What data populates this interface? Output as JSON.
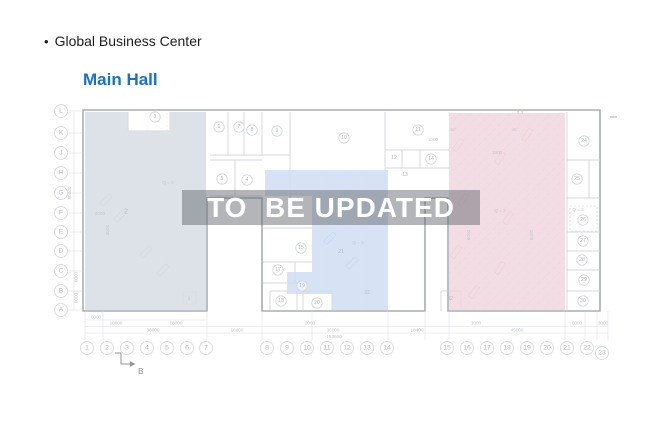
{
  "header": {
    "bullet": "•",
    "title": "Global Business Center",
    "subtitle": "Main Hall"
  },
  "watermark": {
    "text": "TO  BE UPDATED"
  },
  "colors": {
    "title": "#1d1d1f",
    "subtitle": "#1a70c7",
    "wall": "#a8adb5",
    "line": "#c6cad1",
    "faint": "#d8dbe0",
    "grid_dot": "#c0c5cc",
    "circle_stroke": "#d2d5da",
    "label": "#b4b8bf",
    "dim": "#c0c4cb",
    "anno": "#c3c7ce",
    "block_west": "#d6dde4",
    "block_center": "#cddcf2",
    "block_east": "#f0d5dd",
    "hatch": "#e2c3ce",
    "marker": "#8f949b",
    "watermark_band": "rgba(104,108,114,0.5)",
    "watermark_text": "#ffffff",
    "mark_west": "#b6c0cb",
    "mark_center": "#9fb7da",
    "mark_east": "#d4aaba"
  },
  "plan": {
    "row_labels": [
      {
        "t": "L",
        "y": 111
      },
      {
        "t": "K",
        "y": 133
      },
      {
        "t": "J",
        "y": 153
      },
      {
        "t": "H",
        "y": 173
      },
      {
        "t": "G",
        "y": 193
      },
      {
        "t": "F",
        "y": 213
      },
      {
        "t": "E",
        "y": 232
      },
      {
        "t": "D",
        "y": 251
      },
      {
        "t": "C",
        "y": 271
      },
      {
        "t": "B",
        "y": 291
      },
      {
        "t": "A",
        "y": 310
      }
    ],
    "col_labels": [
      {
        "t": "1",
        "x": 87
      },
      {
        "t": "2",
        "x": 107
      },
      {
        "t": "3",
        "x": 127
      },
      {
        "t": "4",
        "x": 147
      },
      {
        "t": "5",
        "x": 167
      },
      {
        "t": "6",
        "x": 187
      },
      {
        "t": "7",
        "x": 206
      },
      {
        "t": "8",
        "x": 267
      },
      {
        "t": "9",
        "x": 287
      },
      {
        "t": "10",
        "x": 307
      },
      {
        "t": "11",
        "x": 327
      },
      {
        "t": "12",
        "x": 347
      },
      {
        "t": "13",
        "x": 367
      },
      {
        "t": "14",
        "x": 387
      },
      {
        "t": "15",
        "x": 447
      },
      {
        "t": "16",
        "x": 467
      },
      {
        "t": "17",
        "x": 487
      },
      {
        "t": "18",
        "x": 507
      },
      {
        "t": "19",
        "x": 527
      },
      {
        "t": "20",
        "x": 547
      },
      {
        "t": "21",
        "x": 567
      },
      {
        "t": "22",
        "x": 587
      },
      {
        "t": "23",
        "x": 602,
        "y": 353
      }
    ],
    "rooms": [
      {
        "n": "3",
        "x": 155,
        "y": 117,
        "c": 1
      },
      {
        "n": "6",
        "x": 219,
        "y": 127,
        "c": 1
      },
      {
        "n": "7",
        "x": 239,
        "y": 127,
        "c": 1
      },
      {
        "n": "8",
        "x": 252,
        "y": 130,
        "c": 1
      },
      {
        "n": "9",
        "x": 277,
        "y": 131,
        "c": 1
      },
      {
        "n": "10",
        "x": 344,
        "y": 138,
        "c": 1
      },
      {
        "n": "11",
        "x": 418,
        "y": 130,
        "c": 1
      },
      {
        "n": "12",
        "x": 394,
        "y": 158,
        "c": 0
      },
      {
        "n": "13",
        "x": 405,
        "y": 175,
        "c": 0
      },
      {
        "n": "14",
        "x": 431,
        "y": 159,
        "c": 1
      },
      {
        "n": "5",
        "x": 222,
        "y": 179,
        "c": 1
      },
      {
        "n": "4",
        "x": 247,
        "y": 180,
        "c": 1
      },
      {
        "n": "2",
        "x": 126,
        "y": 212,
        "c": 0,
        "f": 7
      },
      {
        "n": "1",
        "x": 189,
        "y": 298,
        "c": 0,
        "f": 4.5
      },
      {
        "n": "15",
        "x": 301,
        "y": 248,
        "c": 1
      },
      {
        "n": "17",
        "x": 278,
        "y": 270,
        "c": 1
      },
      {
        "n": "19",
        "x": 302,
        "y": 286,
        "c": 1
      },
      {
        "n": "18",
        "x": 281,
        "y": 301,
        "c": 1
      },
      {
        "n": "20",
        "x": 317,
        "y": 303,
        "c": 1
      },
      {
        "n": "21",
        "x": 341,
        "y": 252,
        "c": 0
      },
      {
        "n": "22",
        "x": 367,
        "y": 293,
        "c": 0
      },
      {
        "n": "32",
        "x": 450,
        "y": 299,
        "c": 0
      },
      {
        "n": "24",
        "x": 584,
        "y": 141,
        "c": 1
      },
      {
        "n": "25",
        "x": 577,
        "y": 179,
        "c": 1
      },
      {
        "n": "26",
        "x": 583,
        "y": 220,
        "c": 1
      },
      {
        "n": "27",
        "x": 583,
        "y": 241,
        "c": 1
      },
      {
        "n": "28",
        "x": 582,
        "y": 260,
        "c": 1
      },
      {
        "n": "29",
        "x": 584,
        "y": 280,
        "c": 1
      },
      {
        "n": "30",
        "x": 583,
        "y": 301,
        "c": 1
      }
    ],
    "annotations": [
      {
        "t": "Q = 3",
        "x": 168,
        "y": 184
      },
      {
        "t": "Q = 3",
        "x": 358,
        "y": 244
      },
      {
        "t": "Q = 3",
        "x": 578,
        "y": 211
      },
      {
        "t": "Q = 3",
        "x": 500,
        "y": 212
      },
      {
        "t": "2000",
        "x": 100,
        "y": 215
      },
      {
        "t": "3000",
        "x": 109,
        "y": 230,
        "rot": -90
      },
      {
        "t": "2.3",
        "x": 520,
        "y": 114
      },
      {
        "t": "45°",
        "x": 453,
        "y": 131
      },
      {
        "t": "45°",
        "x": 515,
        "y": 131
      },
      {
        "t": "1000",
        "x": 433,
        "y": 141
      },
      {
        "t": "1900",
        "x": 497,
        "y": 154
      },
      {
        "t": "6000",
        "x": 470,
        "y": 235,
        "rot": -90
      },
      {
        "t": "6000",
        "x": 533,
        "y": 235,
        "rot": -90
      }
    ],
    "dims_bottom": [
      {
        "t": "6000",
        "x": 96,
        "y": 318.5
      },
      {
        "t": "18000",
        "x": 116,
        "y": 324.5
      },
      {
        "t": "18000",
        "x": 176,
        "y": 324.5
      },
      {
        "t": "2000",
        "x": 310,
        "y": 324.5
      },
      {
        "t": "1000",
        "x": 476,
        "y": 324.5
      },
      {
        "t": "6000",
        "x": 577,
        "y": 324.5
      },
      {
        "t": "3000",
        "x": 603,
        "y": 324.5
      },
      {
        "t": "36000",
        "x": 153,
        "y": 331.3
      },
      {
        "t": "18000",
        "x": 237,
        "y": 331.3
      },
      {
        "t": "36000",
        "x": 333,
        "y": 331.3
      },
      {
        "t": "18400",
        "x": 417,
        "y": 331.3
      },
      {
        "t": "45000",
        "x": 517,
        "y": 331.3
      },
      {
        "t": "153660",
        "x": 334,
        "y": 338
      }
    ],
    "dims_left": [
      {
        "t": "60000",
        "x": 71,
        "y": 193
      },
      {
        "t": "6000",
        "x": 77.5,
        "y": 277
      },
      {
        "t": "6000",
        "x": 77.5,
        "y": 298
      }
    ],
    "outline": "M83,110 H600 V311 H448 V198 H425 V311 H262 V198 H207 V311 H83 Z",
    "interior": [
      [
        210,
        155,
        290,
        155
      ],
      [
        228,
        112,
        228,
        155
      ],
      [
        244,
        112,
        244,
        155
      ],
      [
        262,
        112,
        262,
        155
      ],
      [
        290,
        112,
        290,
        198
      ],
      [
        385,
        112,
        385,
        198
      ],
      [
        385,
        150,
        449,
        150
      ],
      [
        402,
        150,
        402,
        168
      ],
      [
        420,
        150,
        420,
        168
      ],
      [
        385,
        168,
        449,
        168
      ],
      [
        589,
        160,
        589,
        198
      ],
      [
        210,
        160,
        262,
        160
      ],
      [
        235,
        160,
        235,
        196
      ],
      [
        210,
        196,
        262,
        196
      ],
      [
        128,
        112,
        128,
        131
      ],
      [
        170,
        112,
        170,
        131
      ],
      [
        128,
        131,
        170,
        131
      ],
      [
        262,
        228,
        312,
        228
      ],
      [
        262,
        262,
        312,
        262
      ],
      [
        262,
        283,
        295,
        283
      ],
      [
        295,
        262,
        295,
        283
      ],
      [
        270,
        291,
        297,
        291
      ],
      [
        270,
        291,
        270,
        311
      ],
      [
        297,
        291,
        297,
        311
      ],
      [
        303,
        291,
        332,
        291
      ],
      [
        303,
        291,
        303,
        311
      ],
      [
        332,
        291,
        332,
        311
      ],
      [
        567,
        112,
        567,
        311
      ],
      [
        567,
        160,
        600,
        160
      ],
      [
        567,
        198,
        600,
        198
      ],
      [
        567,
        232,
        600,
        232
      ],
      [
        567,
        251,
        600,
        251
      ],
      [
        567,
        270,
        600,
        270
      ],
      [
        567,
        291,
        600,
        291
      ],
      [
        441,
        291,
        461,
        291
      ],
      [
        441,
        291,
        441,
        311
      ],
      [
        461,
        291,
        461,
        311
      ],
      [
        183,
        292,
        196,
        292
      ],
      [
        183,
        292,
        183,
        304
      ],
      [
        196,
        292,
        196,
        304
      ],
      [
        183,
        304,
        196,
        304
      ]
    ],
    "grid_dotted": [
      {
        "x": 107,
        "y1": 113,
        "y2": 309
      },
      {
        "x": 127,
        "y1": 113,
        "y2": 309
      },
      {
        "x": 147,
        "y1": 113,
        "y2": 309
      },
      {
        "x": 167,
        "y1": 113,
        "y2": 309
      },
      {
        "x": 187,
        "y1": 113,
        "y2": 309
      },
      {
        "x": 327,
        "y1": 172,
        "y2": 309
      },
      {
        "x": 347,
        "y1": 172,
        "y2": 309
      },
      {
        "x": 367,
        "y1": 172,
        "y2": 309
      },
      {
        "x": 467,
        "y1": 114,
        "y2": 309
      },
      {
        "x": 487,
        "y1": 114,
        "y2": 309
      },
      {
        "x": 507,
        "y1": 114,
        "y2": 309
      },
      {
        "x": 527,
        "y1": 114,
        "y2": 309
      },
      {
        "x": 547,
        "y1": 114,
        "y2": 309
      }
    ],
    "blocks": [
      {
        "name": "west-block",
        "points": "85,112 128,112 128,131 170,131 170,112 206,112 206,310 85,310",
        "fill": "block_west",
        "op": 0.85
      },
      {
        "name": "center-block",
        "points": "265,170 388,170 388,310 332,310 332,294 287,294 287,272 312,272 312,196 265,196",
        "fill": "block_center",
        "op": 0.8
      },
      {
        "name": "east-block",
        "points": "449,113 565,113 565,310 449,310",
        "fill": "block_east",
        "op": 0.8,
        "hatch": true
      }
    ],
    "furniture": [
      {
        "x": 106,
        "y": 200,
        "r": -45,
        "c": "mark_west"
      },
      {
        "x": 120,
        "y": 216,
        "r": -45,
        "c": "mark_west"
      },
      {
        "x": 146,
        "y": 252,
        "r": -45,
        "c": "mark_west"
      },
      {
        "x": 163,
        "y": 270,
        "r": -45,
        "c": "mark_west"
      },
      {
        "x": 330,
        "y": 238,
        "r": -45,
        "c": "mark_center"
      },
      {
        "x": 352,
        "y": 263,
        "r": -45,
        "c": "mark_center"
      },
      {
        "x": 527,
        "y": 135,
        "r": -55,
        "c": "mark_east"
      },
      {
        "x": 458,
        "y": 145,
        "r": -55,
        "c": "mark_east"
      },
      {
        "x": 500,
        "y": 158,
        "r": -55,
        "c": "mark_east"
      },
      {
        "x": 463,
        "y": 200,
        "r": -55,
        "c": "mark_east"
      },
      {
        "x": 508,
        "y": 218,
        "r": -55,
        "c": "mark_east"
      },
      {
        "x": 456,
        "y": 252,
        "r": -55,
        "c": "mark_east"
      },
      {
        "x": 500,
        "y": 268,
        "r": -55,
        "c": "mark_east"
      },
      {
        "x": 474,
        "y": 292,
        "r": -55,
        "c": "mark_east"
      }
    ],
    "dashed_rect": {
      "x": 570,
      "y": 206,
      "w": 27,
      "h": 25
    },
    "dim_lines": [
      [
        85,
        320,
        207,
        320
      ],
      [
        85,
        326.5,
        608,
        326.5
      ],
      [
        85,
        333,
        608,
        333
      ]
    ],
    "dim_ext": [
      85,
      103,
      207,
      262,
      312,
      388,
      425,
      449,
      565,
      585,
      597,
      608
    ],
    "left_dim_line": [
      74,
      112,
      74,
      311
    ],
    "section_marker": {
      "label": "B",
      "poly": "115,353 121,353 121,364 130,364",
      "ax": 130,
      "ay": 364,
      "tx": 138,
      "ty": 374
    },
    "dash_mark": [
      610,
      117,
      617,
      117
    ]
  }
}
